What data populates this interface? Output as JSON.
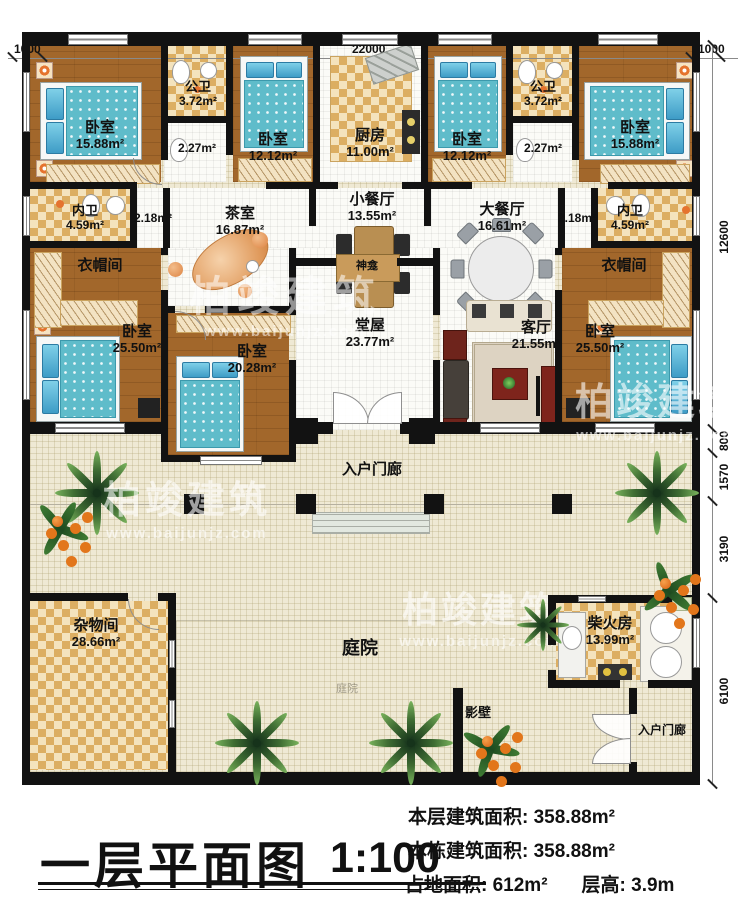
{
  "dims": {
    "top_left": "1000",
    "top_center": "22000",
    "top_right": "1000",
    "right": [
      "12600",
      "800",
      "1570",
      "3190",
      "6100"
    ]
  },
  "rooms": {
    "br_tl": {
      "name": "卧室",
      "area": "15.88m²"
    },
    "bath_tl": {
      "name": "公卫",
      "area": "3.72m²"
    },
    "corr_tl": {
      "area": "2.27m²"
    },
    "br_tl2": {
      "name": "卧室",
      "area": "12.12m²"
    },
    "kitchen": {
      "name": "厨房",
      "area": "11.00m²"
    },
    "br_tr2": {
      "name": "卧室",
      "area": "12.12m²"
    },
    "bath_tr": {
      "name": "公卫",
      "area": "3.72m²"
    },
    "corr_tr": {
      "area": "2.27m²"
    },
    "br_tr": {
      "name": "卧室",
      "area": "15.88m²"
    },
    "ensuite_l": {
      "name": "内卫",
      "area": "4.59m²"
    },
    "hall_l": {
      "area": "2.18m²"
    },
    "tea": {
      "name": "茶室",
      "area": "16.87m²"
    },
    "dining_s": {
      "name": "小餐厅",
      "area": "13.55m²"
    },
    "dining_l": {
      "name": "大餐厅",
      "area": "16.61m²"
    },
    "hall_r": {
      "area": "2.18m²"
    },
    "ensuite_r": {
      "name": "内卫",
      "area": "4.59m²"
    },
    "cloak_l": {
      "name": "衣帽间"
    },
    "br_ml": {
      "name": "卧室",
      "area": "25.50m²"
    },
    "br_c": {
      "name": "卧室",
      "area": "20.28m²"
    },
    "shrine": {
      "name": "神龛"
    },
    "hall_main": {
      "name": "堂屋",
      "area": "23.77m²"
    },
    "living": {
      "name": "客厅",
      "area": "21.55m²"
    },
    "cloak_r": {
      "name": "衣帽间"
    },
    "br_mr": {
      "name": "卧室",
      "area": "25.50m²"
    },
    "porch": {
      "name": "入户门廊"
    },
    "storage": {
      "name": "杂物间",
      "area": "28.66m²"
    },
    "courtyard": {
      "name": "庭院",
      "ghost": "庭院"
    },
    "firewood": {
      "name": "柴火房",
      "area": "13.99m²"
    },
    "screen": {
      "name": "影壁"
    },
    "porch_br": {
      "name": "入户门廊"
    }
  },
  "watermark": {
    "brand": "柏竣建筑",
    "url": "www.baijunjz.com"
  },
  "title": {
    "main": "一层平面图",
    "scale": "1:100"
  },
  "info": {
    "l1": {
      "label": "本层建筑面积:",
      "value": "358.88m²"
    },
    "l2": {
      "label": "本栋建筑面积:",
      "value": "358.88m²"
    },
    "l3": {
      "label": "占地面积:",
      "value": "612m²",
      "label2": "层高:",
      "value2": "3.9m"
    }
  }
}
